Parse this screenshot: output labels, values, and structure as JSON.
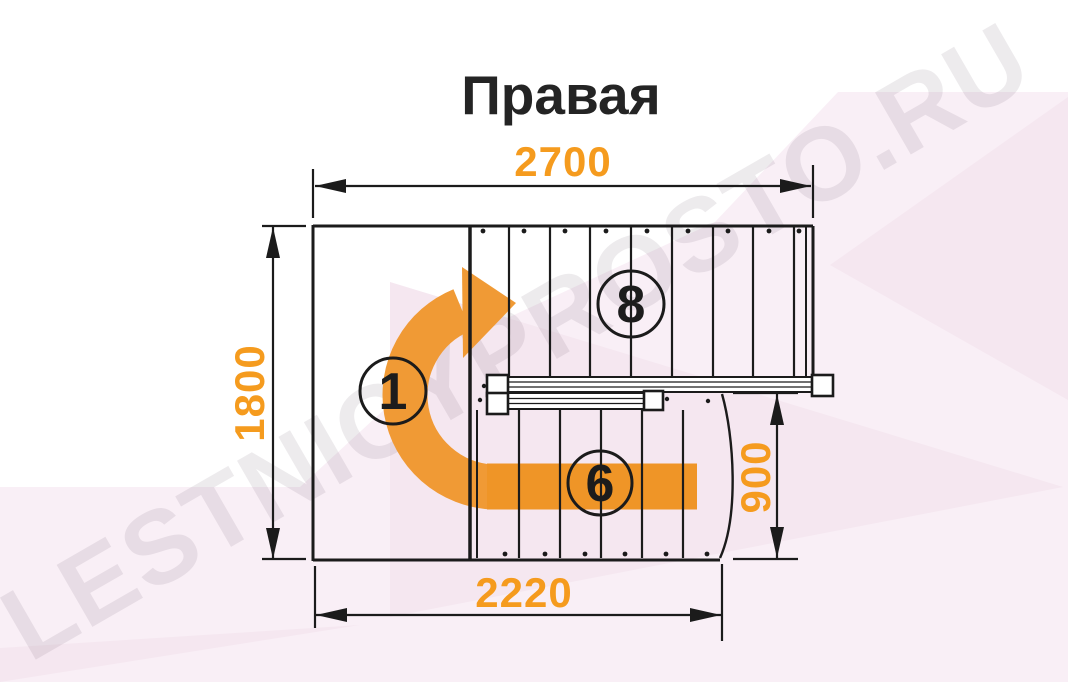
{
  "title": "Правая",
  "watermark_text": "LESTNICYPROSTO.RU",
  "dims": {
    "top": "2700",
    "left": "1800",
    "right": "900",
    "bottom": "2220"
  },
  "steps": {
    "landing": "1",
    "upper_flight": "8",
    "lower_flight": "6"
  },
  "colors": {
    "accent_orange": "#f59b1e",
    "arrow_orange": "#f09a35",
    "line_black": "#1b1b1b",
    "bg_pink_light": "#f9eff6",
    "bg_pink_deep": "#f5e7f0"
  }
}
